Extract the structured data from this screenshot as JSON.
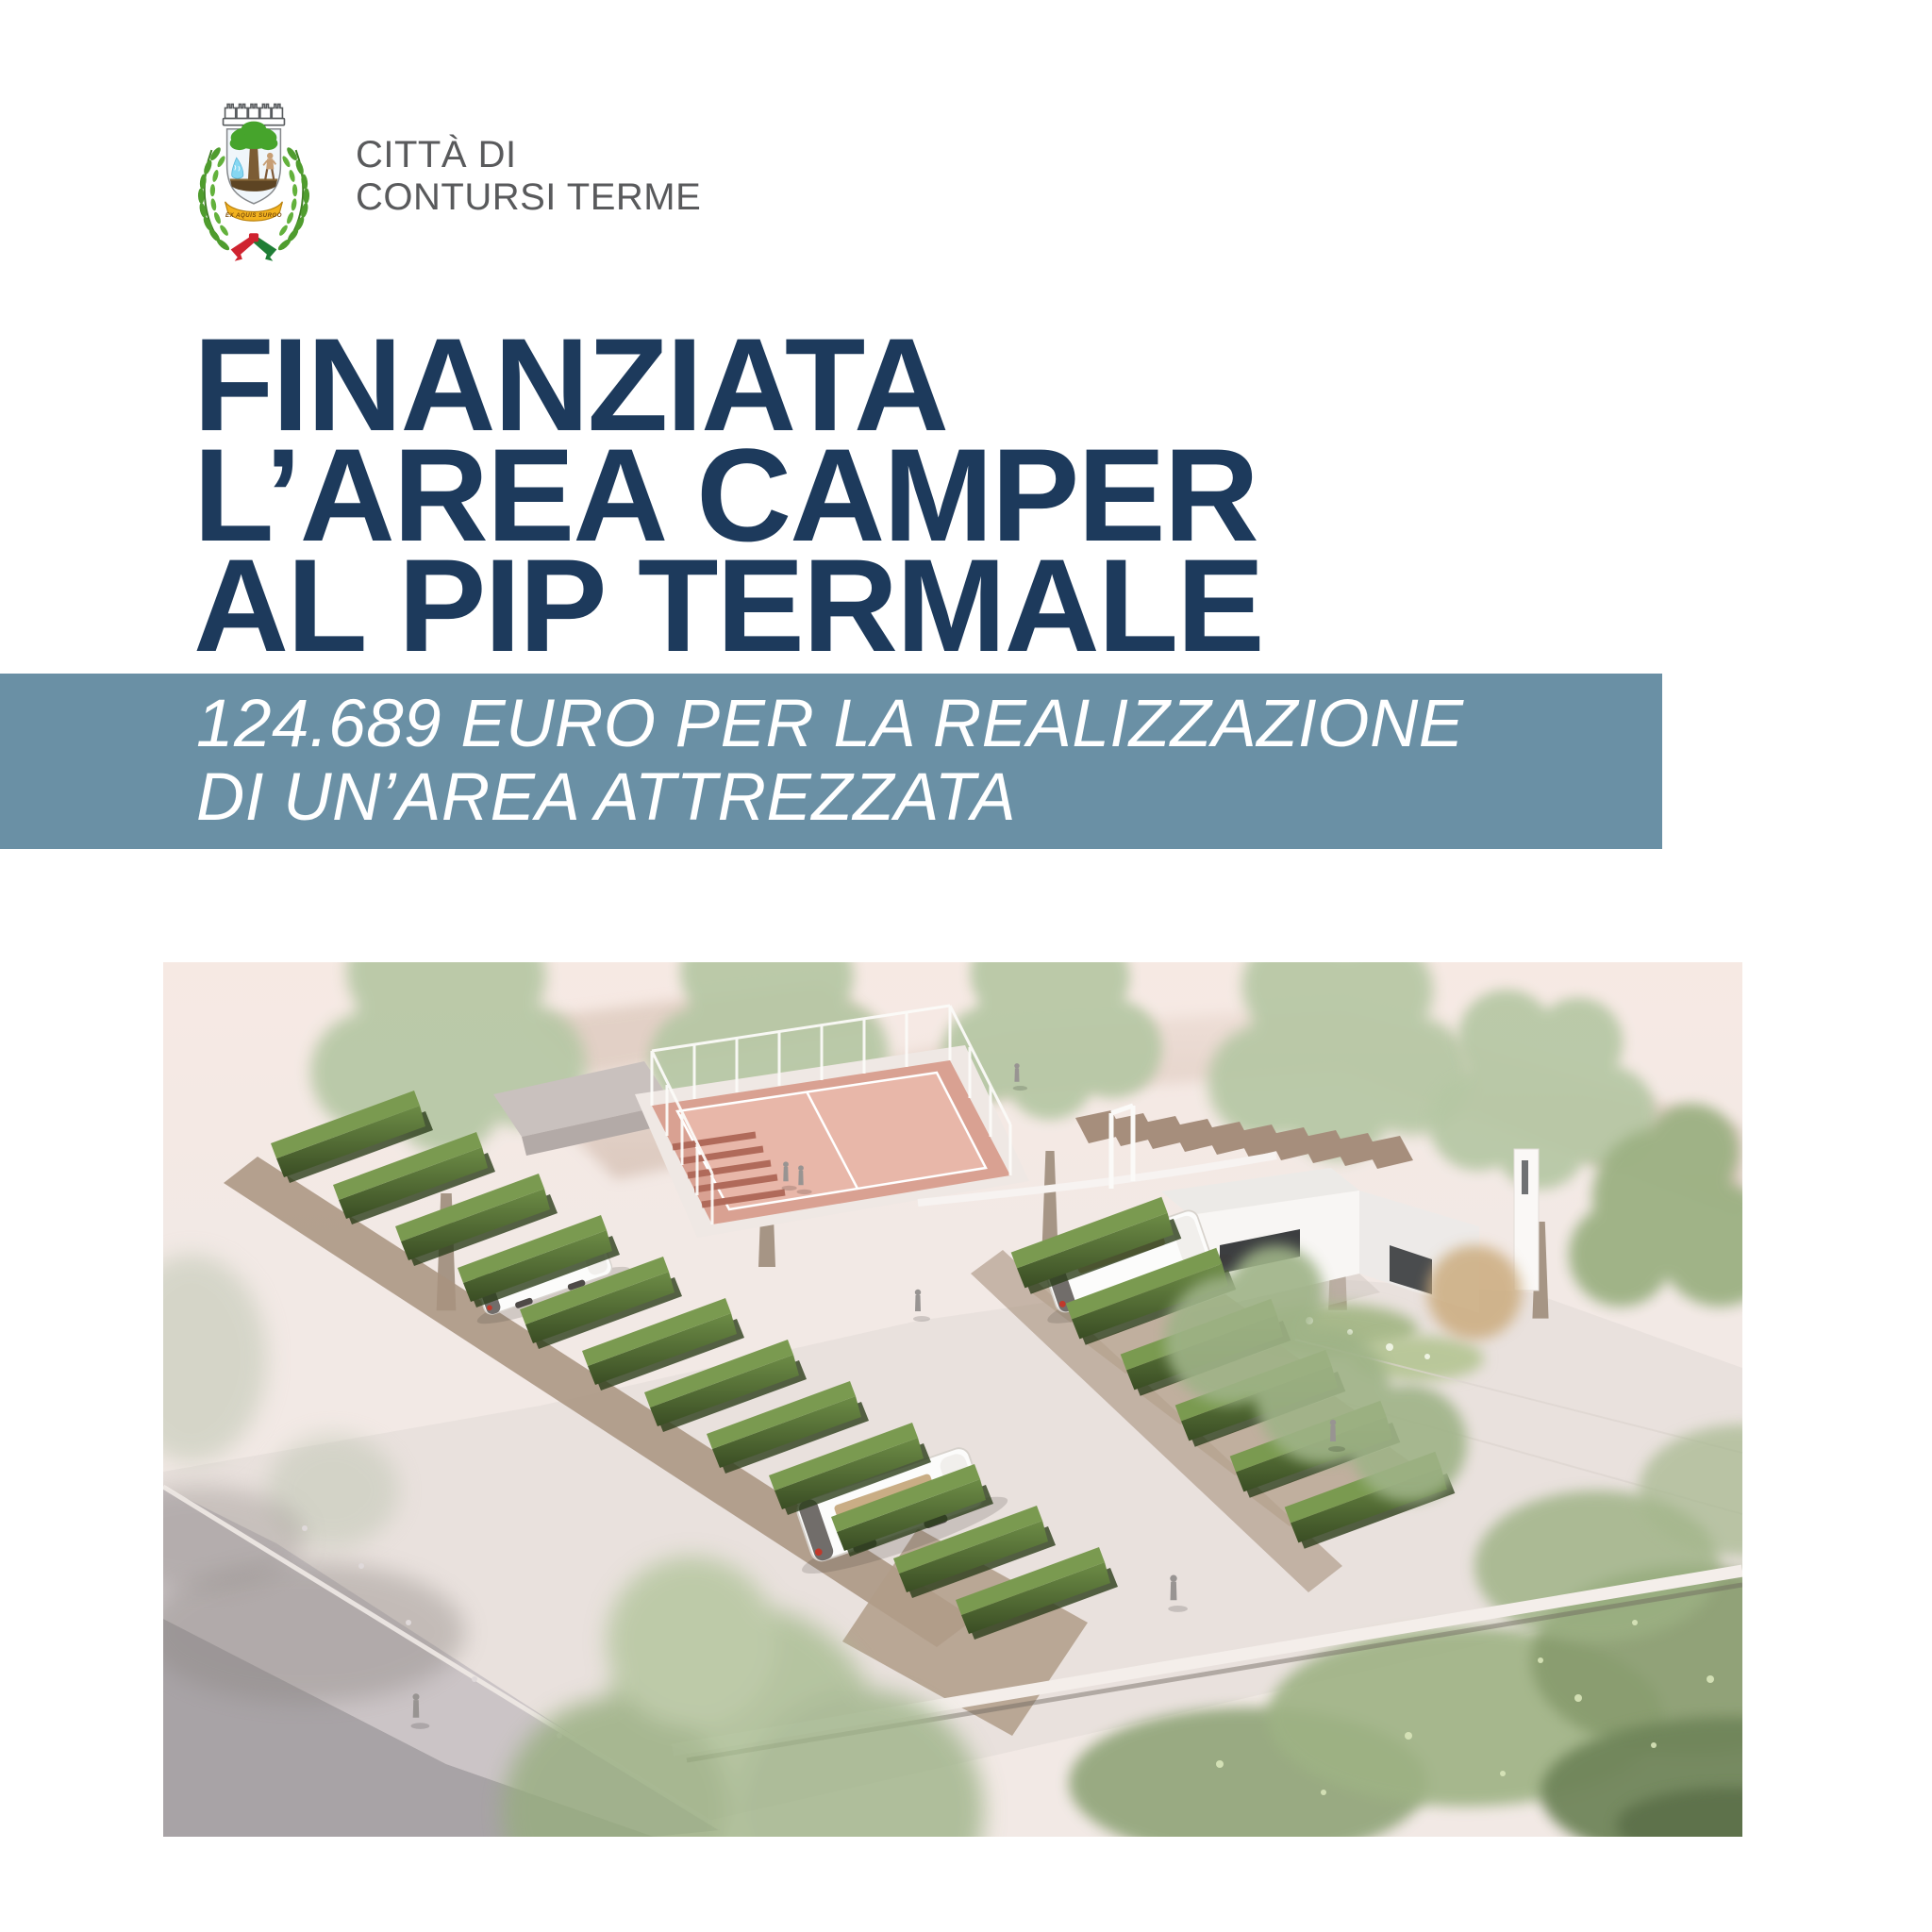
{
  "poster": {
    "background_color": "#ffffff"
  },
  "logo": {
    "crest": {
      "name": "contursi-terme-coat-of-arms",
      "motto": "EX AQUIS SURGO"
    },
    "city_name_line1": "CITTÀ DI",
    "city_name_line2": "CONTURSI TERME",
    "text_color": "#595a5c"
  },
  "headline": {
    "color": "#1d3a5c",
    "lines": [
      "FINANZIATA",
      "L’AREA CAMPER",
      "AL PIP TERMALE"
    ]
  },
  "banner": {
    "background_color": "#6a90a5",
    "text_color": "#ffffff",
    "lines": [
      "124.689 EURO PER LA REALIZZAZIONE",
      "DI UN’AREA ATTREZZATA"
    ]
  },
  "illustration": {
    "type": "architectural-rendering",
    "subject": "aerial view of the planned camper area: parking stalls separated by hedges, campers, padel court, service building, trees and landscaping"
  }
}
